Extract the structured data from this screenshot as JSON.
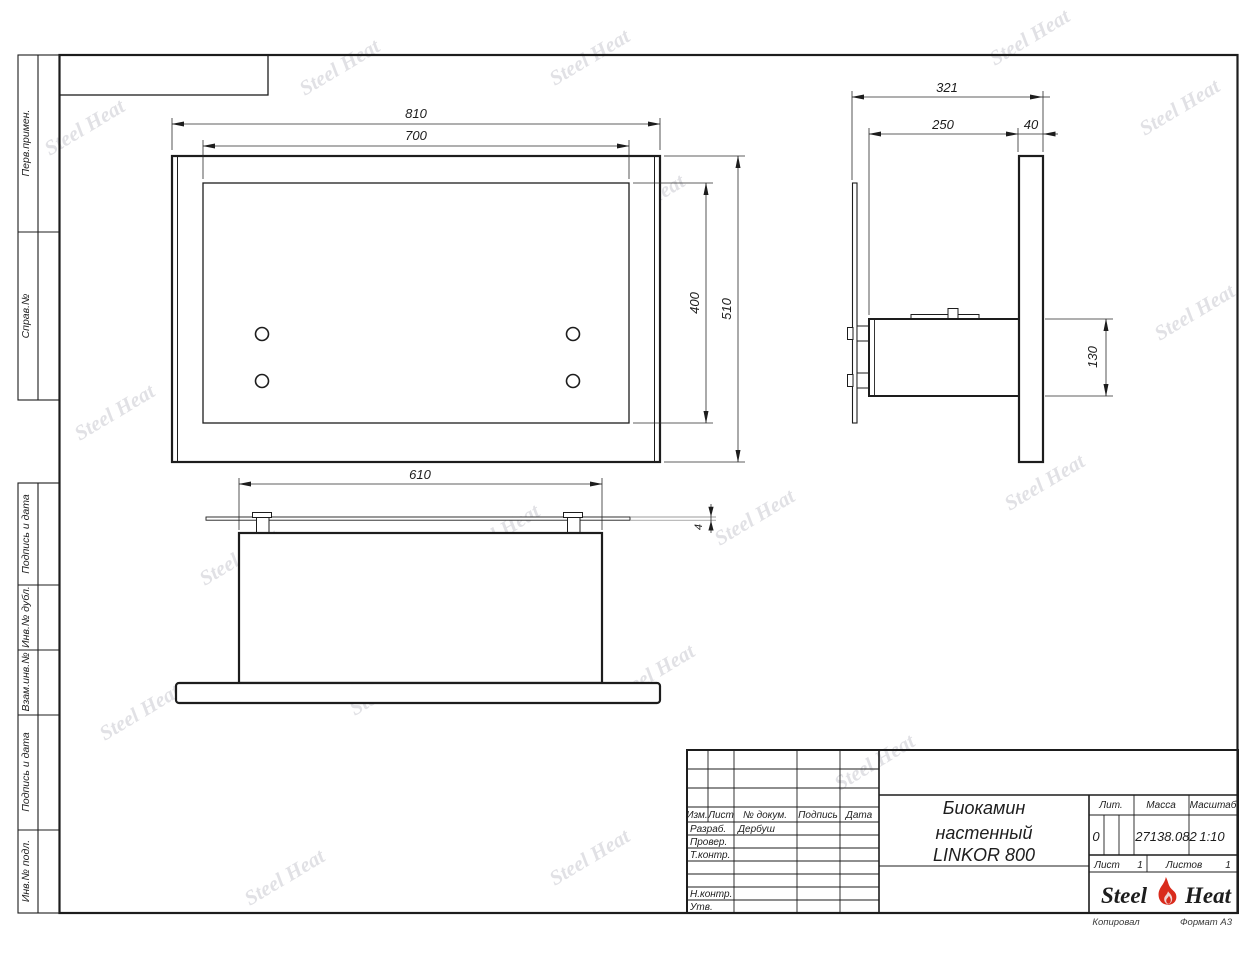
{
  "watermark": {
    "text": "Steel Heat"
  },
  "margin_labels": {
    "perv_primen": "Перв.примен.",
    "sprav_no": "Справ.№",
    "podpis_data_1": "Подпись и дата",
    "inv_dubl": "Инв.№ дубл.",
    "vzam_inv": "Взам.инв.№",
    "podpis_data_2": "Подпись и дата",
    "inv_podl": "Инв.№ подл."
  },
  "dims": {
    "front": {
      "outer_width": "810",
      "inner_width": "700",
      "inner_height": "400",
      "outer_height": "510"
    },
    "side": {
      "total_depth": "321",
      "box_depth": "250",
      "glass_depth": "40",
      "box_height": "130"
    },
    "bottom": {
      "box_width": "610",
      "plate_thickness": "4"
    }
  },
  "title_block": {
    "cols": {
      "izm": "Изм.",
      "list": "Лист",
      "doc": "№ докум.",
      "sign": "Подпись",
      "date": "Дата"
    },
    "rows": {
      "razrab": "Разраб.",
      "prover": "Провер.",
      "tkontr": "Т.контр.",
      "nkontr": "Н.контр.",
      "utv": "Утв."
    },
    "developer": "Дербуш",
    "title_lines": [
      "Биокамин",
      "настенный",
      "LINKOR 800"
    ],
    "lit_label": "Лит.",
    "lit_value": "0",
    "mass_label": "Масса",
    "mass_value": "27138.082",
    "scale_label": "Масштаб",
    "scale_value": "1:10",
    "sheet_label": "Лист",
    "sheet_value": "1",
    "sheets_label": "Листов",
    "sheets_value": "1",
    "logo_left": "Steel",
    "logo_right": "Heat"
  },
  "footer": {
    "copied": "Копировал",
    "format": "Формат А3"
  }
}
